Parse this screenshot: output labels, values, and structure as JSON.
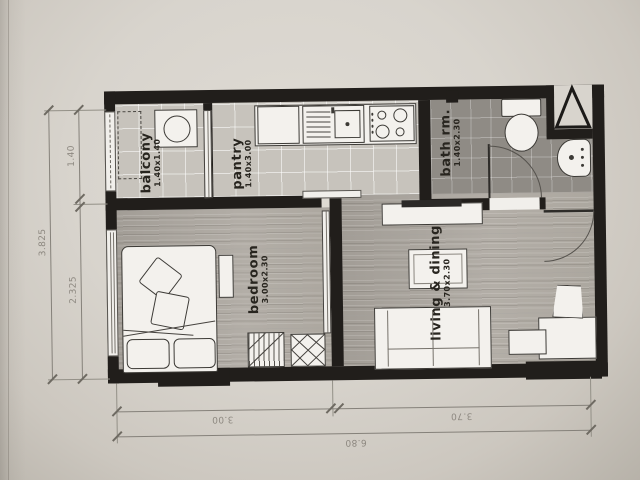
{
  "title": "apartment floor plan",
  "rooms": [
    {
      "name": "balcony",
      "size": "1.40x1.40"
    },
    {
      "name": "pantry",
      "size": "1.40x3.00"
    },
    {
      "name": "bath rm.",
      "size": "1.40x2.30"
    },
    {
      "name": "bedroom",
      "size": "3.00x2.30"
    },
    {
      "name": "living & dining",
      "size": "3.70x2.30"
    }
  ],
  "dimensions": {
    "left": {
      "total": "3.825",
      "top_segment": "1.40",
      "bottom_segment": "2.325"
    },
    "bottom": {
      "total": "6.80",
      "left_segment": "3.00",
      "right_segment": "3.70"
    }
  },
  "furniture": [
    "AC unit",
    "washing machine",
    "kitchen counter",
    "fridge",
    "kitchen sink",
    "stove",
    "toilet",
    "wash basin",
    "bed",
    "pillows",
    "cushions",
    "side table",
    "wardrobe",
    "closet",
    "TV console",
    "TV",
    "coffee table",
    "sofa",
    "desk",
    "chair"
  ],
  "features": [
    "entry door",
    "bath door",
    "sliding balcony door",
    "sliding bedroom door",
    "bedroom window",
    "balcony vent",
    "shaft triangle"
  ],
  "colors": {
    "wall": "#211e1b",
    "paper": "#d8d4cd",
    "wood_floor": "#aba69f",
    "tile_floor": "#c7c3bc",
    "bath_floor": "#8f8b85",
    "dim_text": "#8d8880",
    "label_text": "#28251f"
  }
}
